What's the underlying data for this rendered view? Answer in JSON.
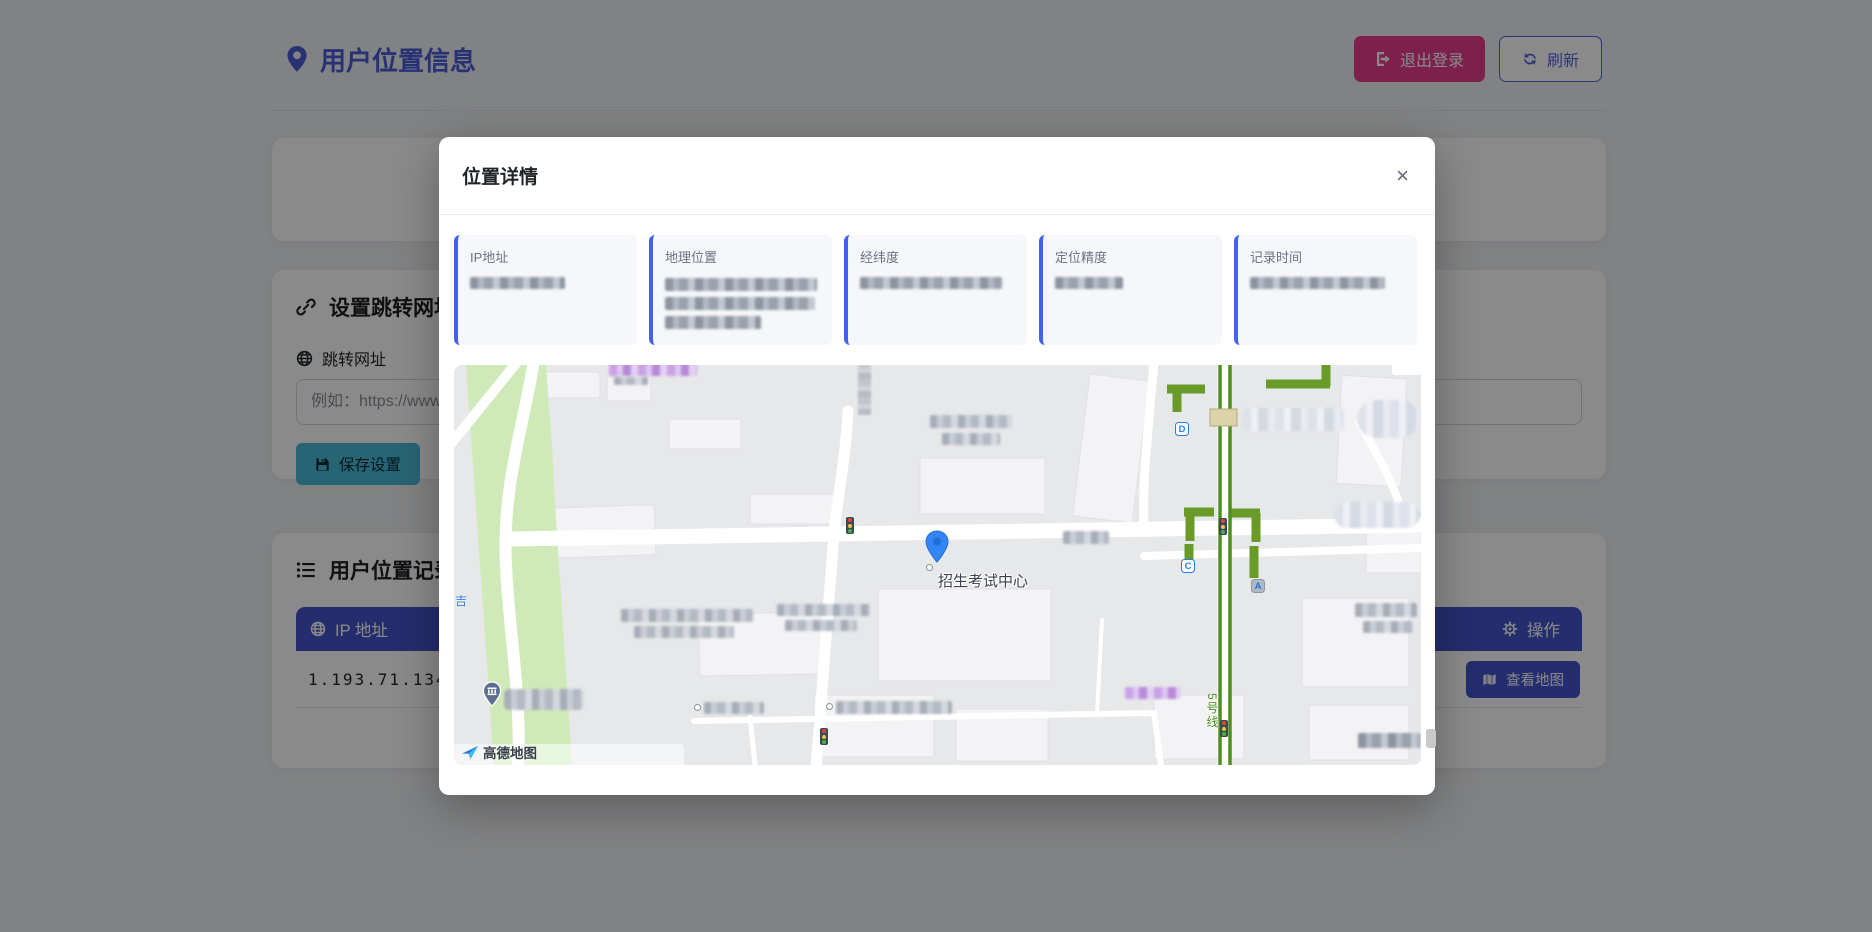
{
  "page": {
    "title": "用户位置信息",
    "logout_label": "退出登录",
    "refresh_label": "刷新"
  },
  "settings": {
    "title": "设置跳转网址",
    "url_label": "跳转网址",
    "url_placeholder": "例如：https://www.",
    "save_label": "保存设置"
  },
  "records": {
    "title": "用户位置记录",
    "col_ip": "IP 地址",
    "col_action": "操作",
    "row_ip": "1.193.71.134",
    "view_map_label": "查看地图"
  },
  "modal": {
    "title": "位置详情",
    "close": "×",
    "cards": [
      {
        "label": "IP地址"
      },
      {
        "label": "地理位置"
      },
      {
        "label": "经纬度"
      },
      {
        "label": "定位精度"
      },
      {
        "label": "记录时间"
      }
    ],
    "map": {
      "poi_label": "招生考试中心",
      "metro_line_label": "5号线",
      "exit_d": "D",
      "exit_c": "C",
      "exit_a": "A",
      "street_char": "吉",
      "attribution": "高德地图"
    }
  },
  "colors": {
    "primary": "#4353c9",
    "title_accent": "#4a5bd6",
    "logout_pink": "#e83e8c",
    "save_teal": "#4ab9d6",
    "card_border_blue": "#4361ee",
    "map_green_path": "#6a9a28",
    "marker_blue": "#3385f5",
    "overlay": "rgba(0,0,0,0.46)"
  }
}
